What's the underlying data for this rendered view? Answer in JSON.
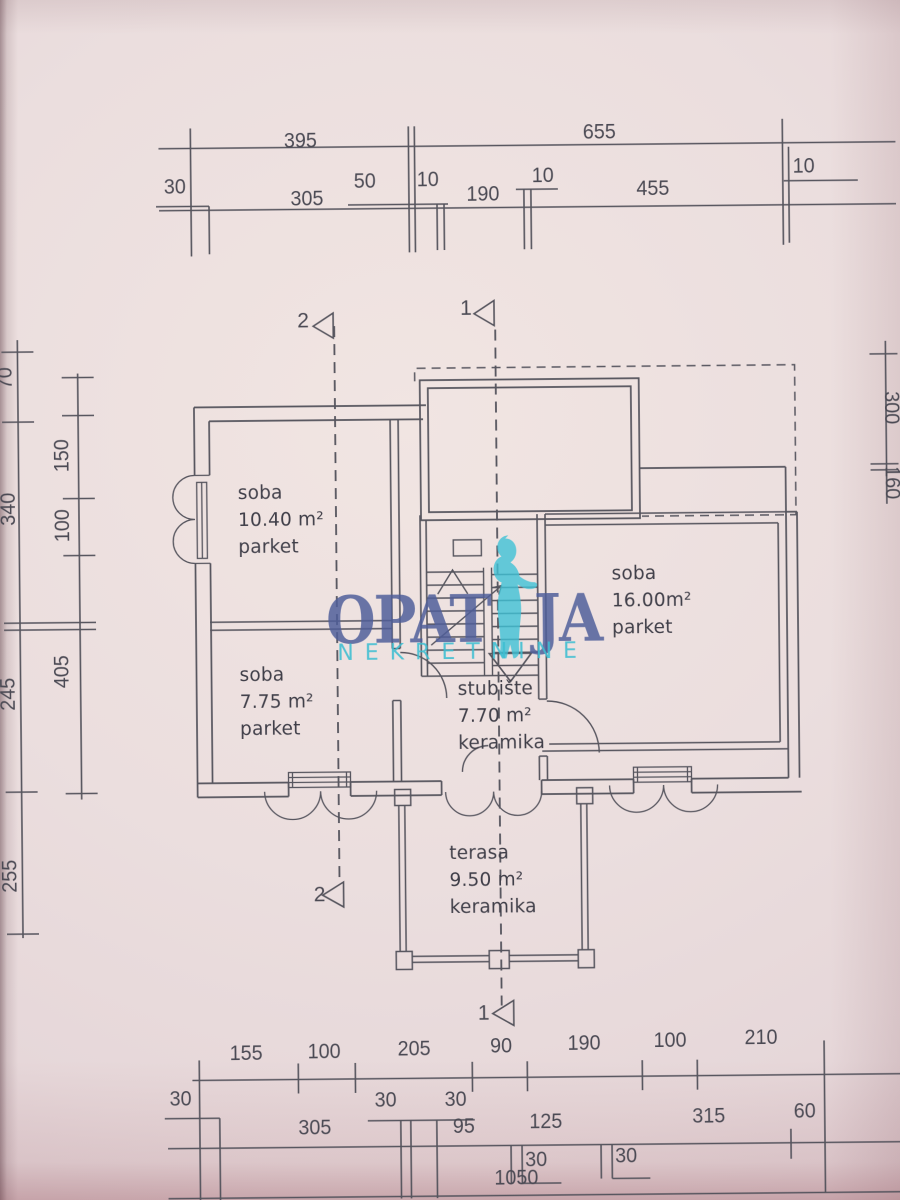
{
  "document_type": "floor-plan-scan",
  "watermark": {
    "word_left": "OPAT",
    "word_right": "JA",
    "subtitle": "NEKRETNINE",
    "figure_icon": "woman-silhouette",
    "color_blue": "#4f5e9a",
    "color_teal": "#3cbed2"
  },
  "section_markers": {
    "s1": "1",
    "s2": "2"
  },
  "rooms": {
    "room1": {
      "name": "soba",
      "area": "10.40 m²",
      "floor": "parket"
    },
    "room2": {
      "name": "soba",
      "area": "7.75 m²",
      "floor": "parket"
    },
    "room3": {
      "name": "soba",
      "area": "16.00m²",
      "floor": "parket"
    },
    "stairs": {
      "name": "stubište",
      "area": "7.70 m²",
      "floor": "keramika"
    },
    "terrace": {
      "name": "terasa",
      "area": "9.50 m²",
      "floor": "keramika"
    }
  },
  "dims": {
    "top_row1": [
      "395",
      "655"
    ],
    "top_row2": [
      "30",
      "50",
      "10",
      "10",
      "10"
    ],
    "top_row3": [
      "305",
      "190",
      "455"
    ],
    "left_outer": [
      "70",
      "340",
      "245",
      "255"
    ],
    "left_inner": [
      "150",
      "100",
      "405"
    ],
    "right_side": [
      "300",
      "160"
    ],
    "bottom_row1": [
      "155",
      "100",
      "205",
      "90",
      "190",
      "100",
      "210"
    ],
    "bottom_row2": [
      "30",
      "30",
      "30"
    ],
    "bottom_row3": [
      "305",
      "95",
      "125",
      "315",
      "60"
    ],
    "bottom_row4": [
      "30",
      "30"
    ],
    "bottom_total": "1050"
  },
  "colors": {
    "paper": "#e9dbdb",
    "line": "#56555e"
  }
}
